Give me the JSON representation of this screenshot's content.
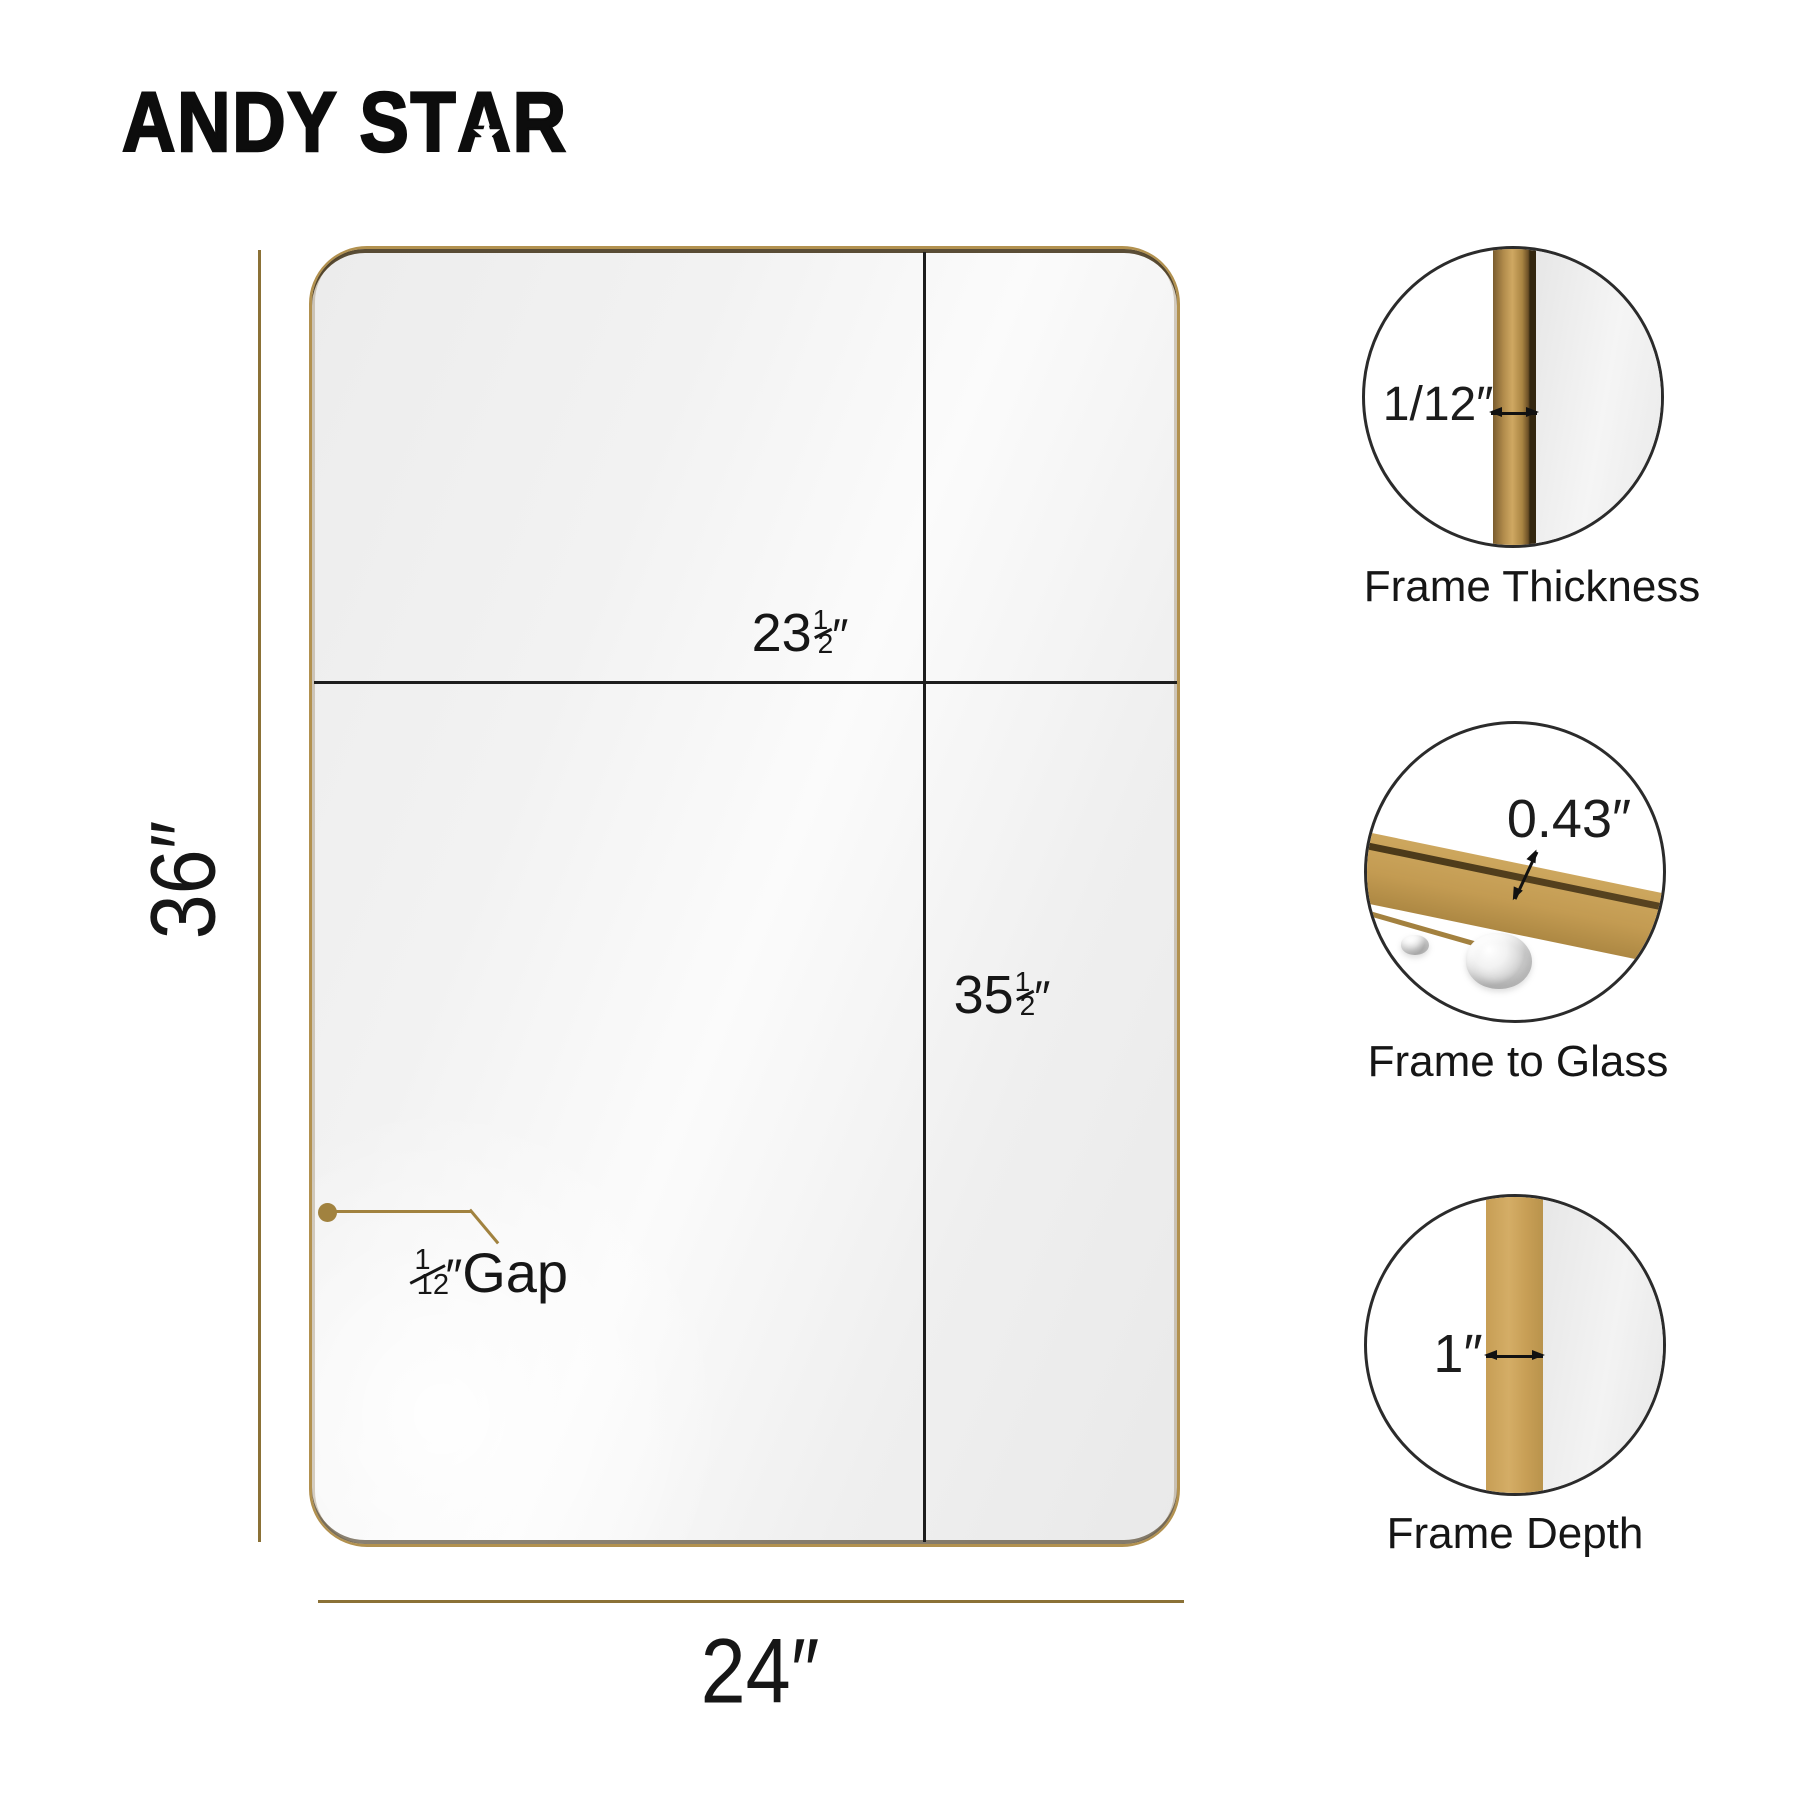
{
  "brand": {
    "prefix": "ANDY ST",
    "star_letter": "A",
    "suffix": "R",
    "star_glyph": "★"
  },
  "dimensions": {
    "height": "36″",
    "width": "24″",
    "glass_width": {
      "int": "23",
      "frac_top": "1",
      "frac_bottom": "2",
      "unit": "″"
    },
    "glass_height": {
      "int": "35",
      "frac_top": "1",
      "frac_bottom": "2",
      "unit": "″"
    },
    "gap": {
      "frac_top": "1",
      "frac_bottom": "12",
      "unit": "″",
      "text": "Gap"
    }
  },
  "callouts": [
    {
      "value": "1/12″",
      "label": "Frame Thickness"
    },
    {
      "value": "0.43″",
      "label": "Frame to Glass"
    },
    {
      "value": "1″",
      "label": "Frame Depth"
    }
  ],
  "colors": {
    "gold_frame": "#b2914f",
    "gold_line": "#8b7136",
    "ink": "#1c1c1c",
    "frame_shadow": "#43331a"
  }
}
